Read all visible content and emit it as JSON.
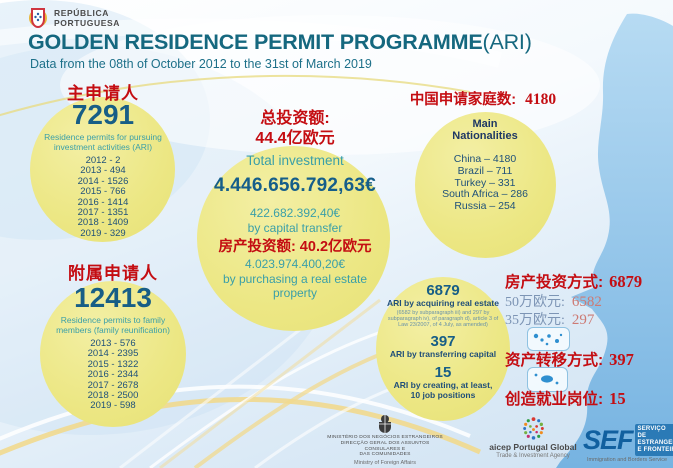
{
  "colors": {
    "title_teal": "#15687f",
    "accent_red": "#c40d12",
    "deep_blue": "#175e86",
    "teal_text": "#3a9fa8",
    "navy_text": "#20527a",
    "circle_yellow": "#ece784",
    "sea_blue": "#82bbe4"
  },
  "header": {
    "gov_logo": {
      "line1": "REPÚBLICA",
      "line2": "PORTUGUESA"
    },
    "title": "GOLDEN RESIDENCE PERMIT PROGRAMME",
    "title_suffix": "(ARI)",
    "subtitle": "Data from the 08th of October 2012 to the 31st of March 2019"
  },
  "main_applicants": {
    "heading": "主申请人",
    "total": "7291",
    "description": "Residence permits for pursuing investment activities (ARI)",
    "by_year": [
      "2012 - 2",
      "2013 - 494",
      "2014 - 1526",
      "2015 - 766",
      "2016 - 1414",
      "2017 - 1351",
      "2018 - 1409",
      "2019 - 329"
    ]
  },
  "family_members": {
    "heading": "附属申请人",
    "total": "12413",
    "description": "Residence permits to family members (family reunification)",
    "by_year": [
      "2013 - 576",
      "2014 - 2395",
      "2015 - 1322",
      "2016 - 2344",
      "2017 - 2678",
      "2018 - 2500",
      "2019 - 598"
    ]
  },
  "investment": {
    "total_label_zh": "总投资额:",
    "total_value_zh": "44.4亿欧元",
    "total_label_en": "Total investment",
    "total_amount": "4.446.656.792,63€",
    "capital_transfer_amount": "422.682.392,40€",
    "capital_transfer_label": "by capital transfer",
    "real_estate_zh": "房产投资额: 40.2亿欧元",
    "real_estate_amount": "4.023.974.400,20€",
    "real_estate_label": "by purchasing a real estate property"
  },
  "nationalities": {
    "heading_label": "中国申请家庭数:",
    "heading_value": "4180",
    "circle_title": "Main Nationalities",
    "list": [
      "China – 4180",
      "Brazil – 711",
      "Turkey – 331",
      "South Africa – 286",
      "Russia – 254"
    ]
  },
  "ari_breakdown": {
    "real_estate_value": "6879",
    "real_estate_label": "ARI by acquiring real estate",
    "real_estate_note": "(6582 by subparagraph iii) and 297 by subparagraph iv), of paragraph d), article 3 of Law 23/2007, of 4 July, as amended)",
    "capital_value": "397",
    "capital_label": "ARI by transferring capital",
    "jobs_value": "15",
    "jobs_label": "ARI by creating, at least, 10 job positions"
  },
  "right_stats": {
    "real_estate": {
      "label": "房产投资方式:",
      "value": "6879"
    },
    "tier_500k": {
      "label": "50万欧元:",
      "value": "6582"
    },
    "tier_350k": {
      "label": "35万欧元:",
      "value": "297"
    },
    "capital_transfer": {
      "label": "资产转移方式:",
      "value": "397"
    },
    "jobs": {
      "label": "创造就业岗位:",
      "value": "15"
    }
  },
  "footer": {
    "mne": {
      "lines": [
        "MINISTÉRIO DOS NEGÓCIOS ESTRANGEIROS",
        "DIRECÇÃO GERAL DOS ASSUNTOS CONSULARES E",
        "DAS COMUNIDADES"
      ],
      "en": "Ministry of Foreign Affairs"
    },
    "aicep": {
      "name": "aicep Portugal Global",
      "tagline": "Trade & Investment Agency"
    },
    "sef": {
      "acronym": "SEF",
      "lines": [
        "SERVIÇO",
        "DE ESTRANGEIROS",
        "E FRONTEIRAS"
      ],
      "en": "Immigration and Borders Service"
    }
  }
}
